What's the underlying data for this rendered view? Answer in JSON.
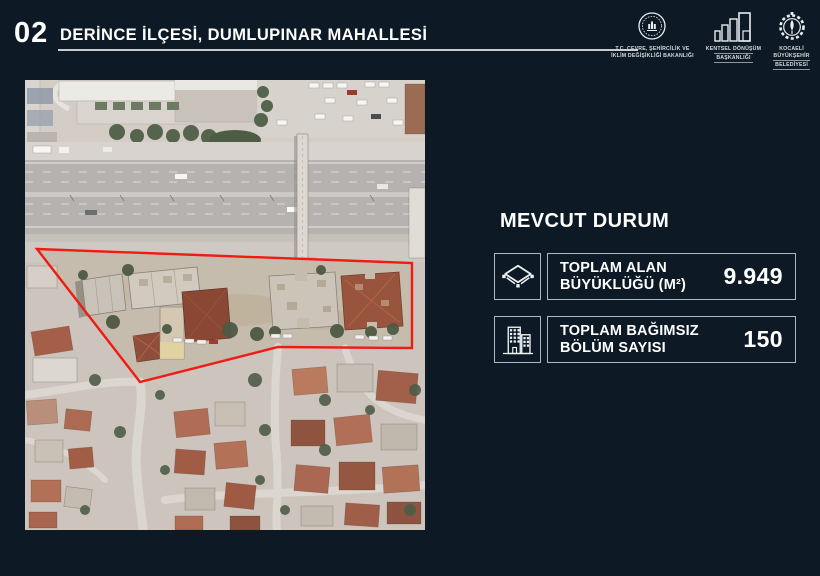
{
  "slide": {
    "number": "02",
    "title": "DERİNCE İLÇESİ, DUMLUPINAR MAHALLESİ",
    "background_color": "#0d1a25"
  },
  "header_logos": {
    "ministry": {
      "lines": [
        "T.C. ÇEVRE, ŞEHİRCİLİK VE",
        "İKLİM DEĞİŞİKLİĞİ BAKANLIĞI"
      ]
    },
    "urban_transformation": {
      "lines": [
        "KENTSEL DÖNÜŞÜM",
        "BAŞKANLIĞI"
      ]
    },
    "municipality": {
      "lines": [
        "KOCAELİ",
        "BÜYÜKŞEHİR",
        "BELEDİYESİ"
      ]
    }
  },
  "map": {
    "boundary_color": "#ee1c12"
  },
  "panel": {
    "heading": "MEVCUT DURUM",
    "cards": [
      {
        "icon": "area-icon",
        "label_line1": "TOPLAM ALAN",
        "label_line2": "BÜYÜKLÜĞÜ (M²)",
        "value": "9.949"
      },
      {
        "icon": "buildings-icon",
        "label_line1": "TOPLAM BAĞIMSIZ",
        "label_line2": "BÖLÜM SAYISI",
        "value": "150"
      }
    ]
  }
}
